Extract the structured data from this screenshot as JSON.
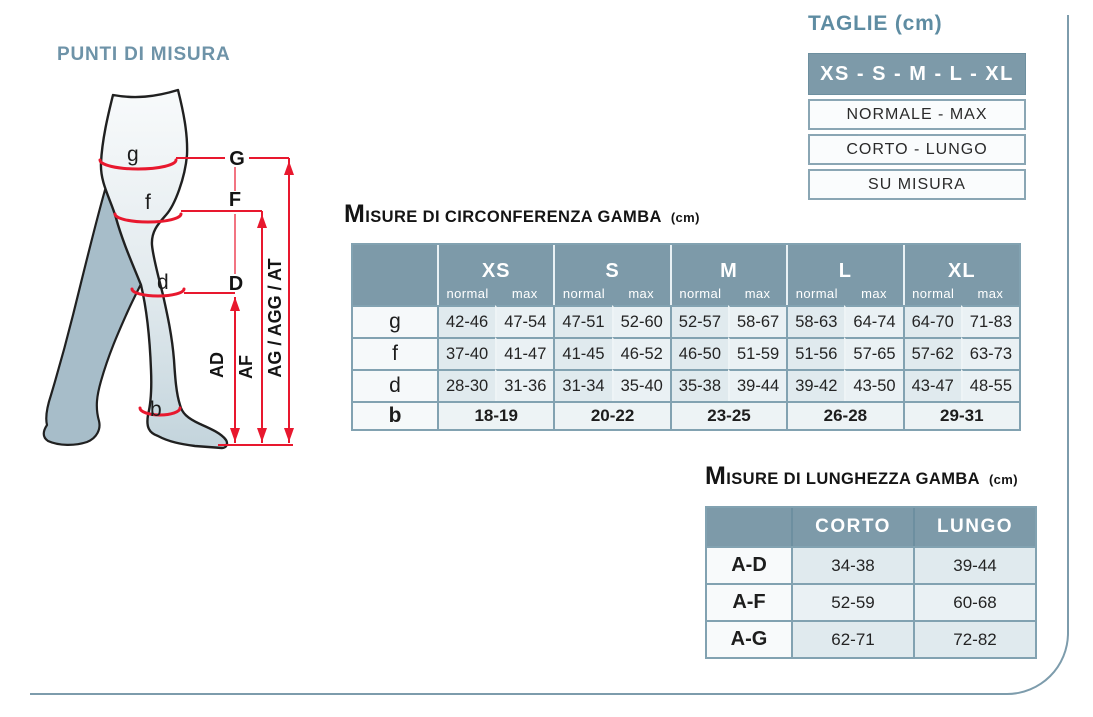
{
  "colors": {
    "header_bg": "#7d9aa9",
    "table_border": "#82a2b1",
    "cell_light": "#e2ebef",
    "cell_lighter": "#eaf1f4",
    "red_marker": "#e8182e",
    "section_title_blue": "#6e93a8",
    "frame_line": "#7d9cac"
  },
  "punti": {
    "title": "PUNTI DI MISURA",
    "leg_labels": {
      "g": "g",
      "f": "f",
      "d": "d",
      "b": "b"
    },
    "line_labels": {
      "G": "G",
      "F": "F",
      "D": "D"
    },
    "length_labels": {
      "ad": "AD",
      "af": "AF",
      "ag": "AG / AGG / AT"
    }
  },
  "taglie": {
    "title": "TAGLIE (cm)",
    "header": "XS - S - M - L - XL",
    "rows": [
      "NORMALE - MAX",
      "CORTO - LUNGO",
      "SU MISURA"
    ]
  },
  "circonferenza": {
    "title_main": "MISURE DI CIRCONFERENZA GAMBA",
    "title_unit": "(cm)",
    "sizes": [
      "XS",
      "S",
      "M",
      "L",
      "XL"
    ],
    "sub_headers": [
      "normal",
      "max"
    ],
    "rows": [
      {
        "label": "g",
        "values": [
          "42-46",
          "47-54",
          "47-51",
          "52-60",
          "52-57",
          "58-67",
          "58-63",
          "64-74",
          "64-70",
          "71-83"
        ]
      },
      {
        "label": "f",
        "values": [
          "37-40",
          "41-47",
          "41-45",
          "46-52",
          "46-50",
          "51-59",
          "51-56",
          "57-65",
          "57-62",
          "63-73"
        ]
      },
      {
        "label": "d",
        "values": [
          "28-30",
          "31-36",
          "31-34",
          "35-40",
          "35-38",
          "39-44",
          "39-42",
          "43-50",
          "43-47",
          "48-55"
        ]
      }
    ],
    "row_b": {
      "label": "b",
      "values": [
        "18-19",
        "20-22",
        "23-25",
        "26-28",
        "29-31"
      ]
    }
  },
  "lunghezza": {
    "title_main": "MISURE DI LUNGHEZZA GAMBA",
    "title_unit": "(cm)",
    "headers": [
      "CORTO",
      "LUNGO"
    ],
    "rows": [
      {
        "label": "A-D",
        "values": [
          "34-38",
          "39-44"
        ]
      },
      {
        "label": "A-F",
        "values": [
          "52-59",
          "60-68"
        ]
      },
      {
        "label": "A-G",
        "values": [
          "62-71",
          "72-82"
        ]
      }
    ]
  }
}
